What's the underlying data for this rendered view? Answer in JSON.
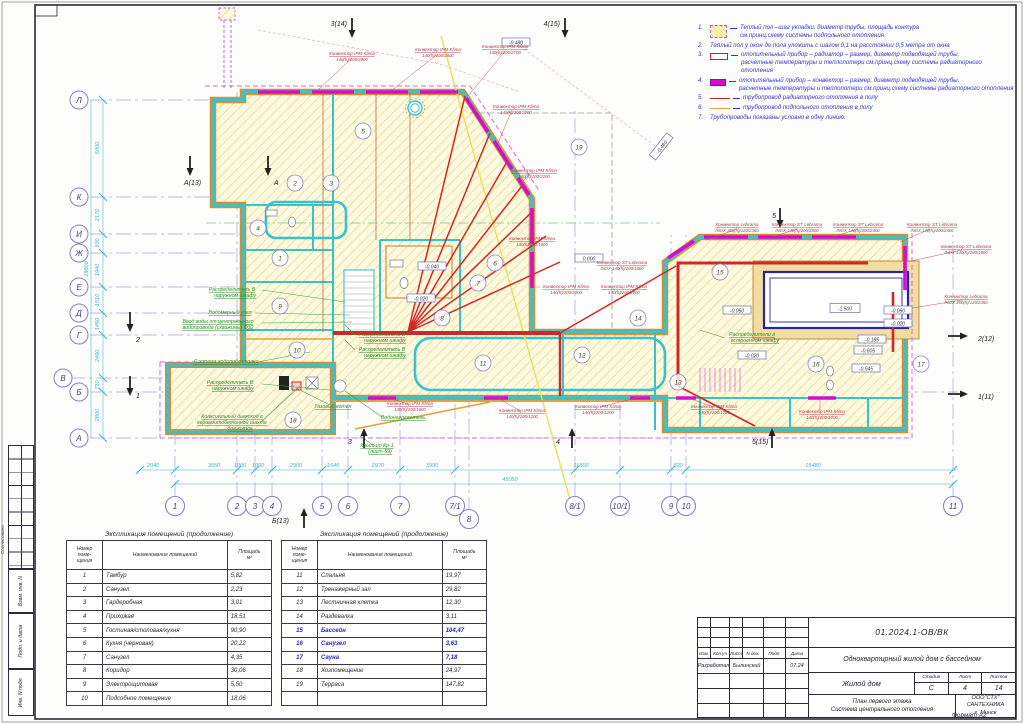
{
  "sheet": {
    "format": "Формат А2",
    "side_stamp": {
      "agreed": "Согласовано",
      "repl_inv": "Взам. инв. N",
      "sign_date": "Подп. и дата",
      "inv_no": "Инв. N подл."
    }
  },
  "legend": {
    "items": [
      {
        "num": "1.",
        "text": "Теплый пол –шаг укладки, диаметр трубы, площадь контура\nсм.принц.схему системы подпольного отопления"
      },
      {
        "num": "2.",
        "text": "Теплый пол у окон до пола уложить с шагом 0,1 на расстоянии 0,5 метра от окна"
      },
      {
        "num": "3.",
        "text": "отопительный прибор – радиатор – размер, диаметр подводящей трубы,\nрасчетные температуры и теплопотери см.принц.схему системы радиаторного отопления"
      },
      {
        "num": "4.",
        "text": "отопительный прибор – конвектор – размер, диаметр подводящей трубы,\nрасчетные температуры и теплопотери см.принц.схему системы радиаторного отопления"
      },
      {
        "num": "5.",
        "text": "трубопровод радиаторного отопления в полу"
      },
      {
        "num": "6.",
        "text": "трубопровод подпольного отопления в полу"
      },
      {
        "num": "7.",
        "text": "Трубопроводы показаны условно в одну линию."
      }
    ]
  },
  "axes": {
    "left": [
      "Л",
      "К",
      "И",
      "Ж",
      "Е",
      "Д",
      "Г",
      "В",
      "Б",
      "А"
    ],
    "left_dims": [
      "5800",
      "2170",
      "930",
      "1940",
      "1510",
      "1450",
      "2490",
      "710",
      "2800"
    ],
    "left_total": "19800",
    "bottom": [
      "1",
      "2",
      "3",
      "4",
      "5",
      "6",
      "7",
      "7/1",
      "8",
      "8/1",
      "10/1",
      "9",
      "10",
      "11"
    ],
    "bottom_dims": [
      "2040",
      "3550",
      "1000",
      "1000",
      "2900",
      "1540",
      "2970",
      "3990",
      "11800",
      "820",
      "15480"
    ],
    "bottom_total": "45050"
  },
  "sections": [
    "3(14)",
    "4(15)",
    "А(13)",
    "А",
    "5",
    "2(12)",
    "1(11)",
    "5(15)",
    "Б(13)",
    "3",
    "4",
    "1",
    "2"
  ],
  "rooms": [
    "1",
    "2",
    "3",
    "4",
    "5",
    "6",
    "7",
    "8",
    "9",
    "10",
    "11",
    "12",
    "13",
    "14",
    "15",
    "16",
    "17",
    "18",
    "19"
  ],
  "elevations": [
    "-0.480",
    "-0.480",
    "0.000",
    "-0.040",
    "-0.020",
    "-1.500",
    "-0.050",
    "-0.050",
    "-0.020",
    "-0.185",
    "-0.605",
    "-0.945",
    "-0.020"
  ],
  "plan": {
    "convectors": [
      {
        "name": "Конвектор IPM Klima",
        "spec": "140(h)/200/2800"
      },
      {
        "name": "Конвектор IPM Klima",
        "spec": "140(h)/200/2800"
      },
      {
        "name": "Конвектор IPM Klima",
        "spec": "140(h)/200/2700"
      },
      {
        "name": "Конвектор IPM Klima",
        "spec": "140(h)/200/2700"
      },
      {
        "name": "Конвектор IPM Klima",
        "spec": "140(h)/200/2200"
      },
      {
        "name": "Конвектор IPM Klima",
        "spec": "140(h)/200/1000"
      },
      {
        "name": "Конвектор ST Lebrama",
        "spec": "INOX 140(h)/200/1800"
      },
      {
        "name": "Конвектор IPM Klima",
        "spec": "140(h)/200/2000"
      },
      {
        "name": "Конвектор IPM Klima",
        "spec": "140(h)/200/2000"
      },
      {
        "name": "Конвектор Lebrama",
        "spec": "INOX 350(h)/120/2350"
      },
      {
        "name": "Конвектор ST Lebrama",
        "spec": "INOX 140(h)/200/2800"
      },
      {
        "name": "Конвектор ST Lebrama",
        "spec": "INOX 140(h)/200/2400"
      },
      {
        "name": "Конвектор ST Lebrama",
        "spec": "INOX 140(h)/200/2400"
      },
      {
        "name": "Конвектор ST Lebrama",
        "spec": "INOX 140(h)/200/1500"
      },
      {
        "name": "Конвектор Lebrama",
        "spec": "INOX 350(h)/120/2350"
      },
      {
        "name": "Конвектор IPM Klima",
        "spec": "140(h)/200/1600"
      },
      {
        "name": "Конвектор IPM Klima",
        "spec": "140(h)/200/1200"
      },
      {
        "name": "Конвектор IPM Klima",
        "spec": "140(h)/200/1200"
      },
      {
        "name": "Конвектор IPM Klima",
        "spec": "140(h)/200/1200"
      },
      {
        "name": "Конвектор IPM Klima",
        "spec": "140(h)/200/1200"
      }
    ],
    "green": [
      "Распределитель В",
      "наружном шкафу",
      "Водомерный узел",
      "Ввод воды от центрального",
      "водопровода (скважины) Ф32",
      "Система водоподготовки",
      "Распределитель В",
      "наружном шкафу",
      "Коаксиальный дымоход в",
      "керамзитобетонной шахте",
      "для котла",
      "Газовый котел",
      "Распределитель В",
      "наружном шкафу",
      "Распределитель В",
      "наружном шкафу",
      "Водонагреватель",
      "Крыльцо Кр-1",
      "(лист 59)",
      "Распределители в",
      "встроенном шкафу"
    ]
  },
  "tables": {
    "title": "Экспликация помещений (продолжение)",
    "headers": {
      "num": "Номер\nпоме-\nщения",
      "name": "Наименование помещений",
      "area": "Площадь\nм²"
    },
    "t1": [
      {
        "n": "1",
        "name": "Тамбур",
        "area": "5,82"
      },
      {
        "n": "2",
        "name": "Санузел",
        "area": "2,23"
      },
      {
        "n": "3",
        "name": "Гардеробная",
        "area": "3,01"
      },
      {
        "n": "4",
        "name": "Прихожая",
        "area": "18,51"
      },
      {
        "n": "5",
        "name": "Гостиная/столовая/кухня",
        "area": "90,90"
      },
      {
        "n": "6",
        "name": "Кухня (черновая)",
        "area": "20,22"
      },
      {
        "n": "7",
        "name": "Санузел",
        "area": "4,35"
      },
      {
        "n": "8",
        "name": "Коридор",
        "area": "30,06"
      },
      {
        "n": "9",
        "name": "Электрощитовая",
        "area": "5,50"
      },
      {
        "n": "10",
        "name": "Подсобное помещение",
        "area": "18,06"
      }
    ],
    "t2": [
      {
        "n": "11",
        "name": "Спальня",
        "area": "19,97"
      },
      {
        "n": "12",
        "name": "Тренажерный зал",
        "area": "29,82"
      },
      {
        "n": "13",
        "name": "Лестничная клетка",
        "area": "12,30"
      },
      {
        "n": "14",
        "name": "Раздевалка",
        "area": "3,11"
      },
      {
        "n": "15",
        "name": "Бассейн",
        "area": "104,47"
      },
      {
        "n": "16",
        "name": "Санузел",
        "area": "3,63"
      },
      {
        "n": "17",
        "name": "Сауна",
        "area": "7,18"
      },
      {
        "n": "18",
        "name": "Хозпомещение",
        "area": "24,97"
      },
      {
        "n": "19",
        "name": "Терраса",
        "area": "147,82"
      }
    ]
  },
  "titleblock": {
    "doc_no": "01.2024.1-ОВ/ВК",
    "project": "Одноквартирный жилой дом с бассейном",
    "object": "Жилой дом",
    "stage_label": "Стадия",
    "sheet_label": "Лист",
    "sheets_label": "Листов",
    "stage": "С",
    "sheet": "4",
    "sheets": "14",
    "title_line1": "План первого этажа",
    "title_line2": "Система центрального отопления",
    "company_line1": "ООО\"СТХ\"",
    "company_line2": "САНТЕХНИКА",
    "company_line3": "г. Минск",
    "cols": [
      "Изм.",
      "Кол.уч",
      "Лист",
      "N док.",
      "Подп.",
      "Дата"
    ],
    "rows": {
      "developed": "Разработал",
      "developer": "Былинский",
      "date": "07.24"
    }
  }
}
